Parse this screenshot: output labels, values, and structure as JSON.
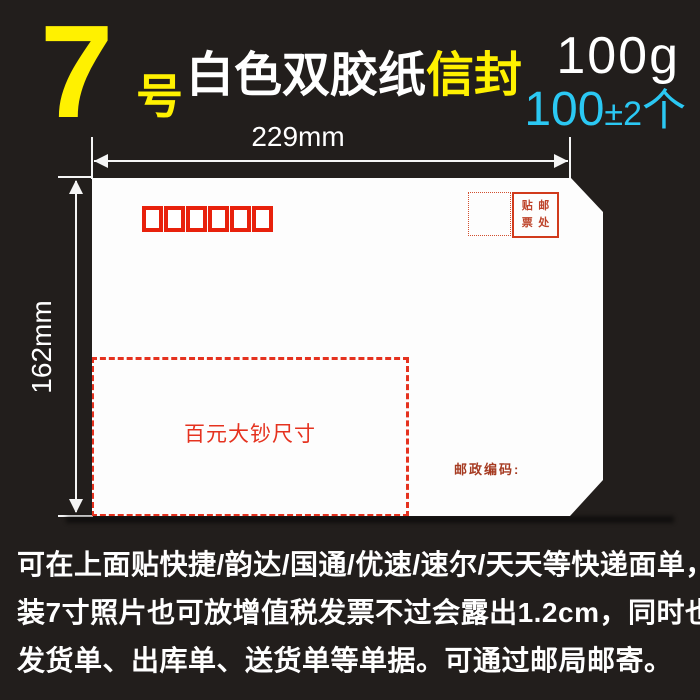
{
  "header": {
    "size_number": "7",
    "size_unit": "号",
    "material": "白色双胶纸",
    "product": "信封",
    "weight": "100g",
    "quantity": {
      "main": "100",
      "pm": "±",
      "tolerance": "2",
      "unit": "个"
    }
  },
  "dimensions": {
    "width": "229mm",
    "height": "162mm"
  },
  "envelope": {
    "postal_code_boxes": 6,
    "stamp_area": {
      "chars": [
        "贴",
        "邮",
        "票",
        "处"
      ],
      "label_meaning": "贴邮票处"
    },
    "banknote_hint": "百元大钞尺寸",
    "postcode_label": "邮政编码:"
  },
  "description_lines": [
    "可在上面贴快捷/韵达/国通/优速/速尔/天天等快递面单，可",
    "装7寸照片也可放增值税发票不过会露出1.2cm，同时也可装",
    "发货单、出库单、送货单等单据。可通过邮局邮寄。"
  ],
  "colors": {
    "background": "#221E1C",
    "accent_yellow": "#FFF100",
    "accent_cyan": "#2BC8F3",
    "text_white": "#FFFFFF",
    "envelope_white": "#FDFDFD",
    "red_postal_boxes": "#E8210C",
    "red_dashed_box": "#E5321F",
    "red_stamp_box": "#D13A1C",
    "red_postcode_text": "#A63B22"
  }
}
